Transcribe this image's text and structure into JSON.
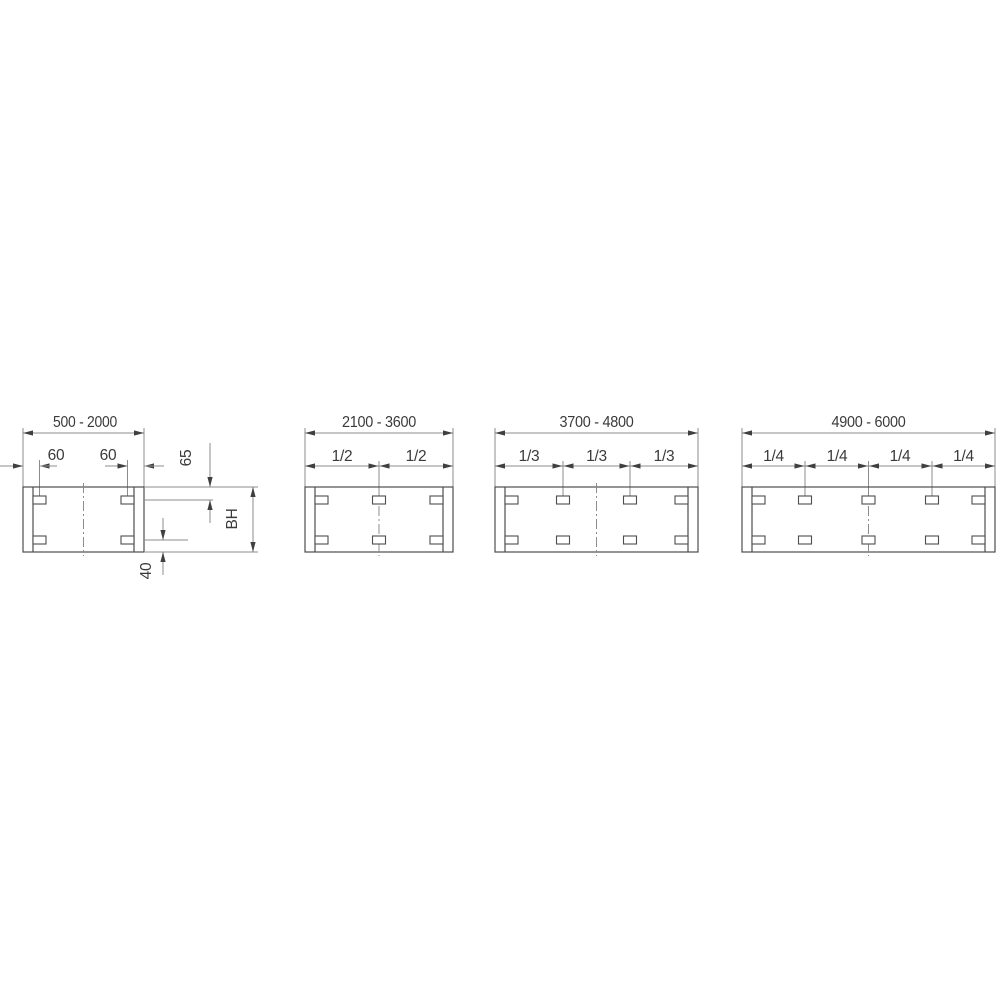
{
  "panels": [
    {
      "range_label": "500 - 2000",
      "left_hole_offset_label": "60",
      "right_hole_offset_label": "60",
      "top_hole_offset_label": "65",
      "height_label": "BH",
      "bottom_hole_offset_label": "40"
    },
    {
      "range_label": "2100 - 3600",
      "fractions": [
        "1/2",
        "1/2"
      ]
    },
    {
      "range_label": "3700 - 4800",
      "fractions": [
        "1/3",
        "1/3",
        "1/3"
      ]
    },
    {
      "range_label": "4900 - 6000",
      "fractions": [
        "1/4",
        "1/4",
        "1/4",
        "1/4"
      ]
    }
  ],
  "colors": {
    "object-line": "#4d4d4d",
    "dimension-line": "#8c8c8c",
    "arrowhead": "#3f3f3f",
    "text": "#3a3a3a",
    "background": "#ffffff"
  }
}
